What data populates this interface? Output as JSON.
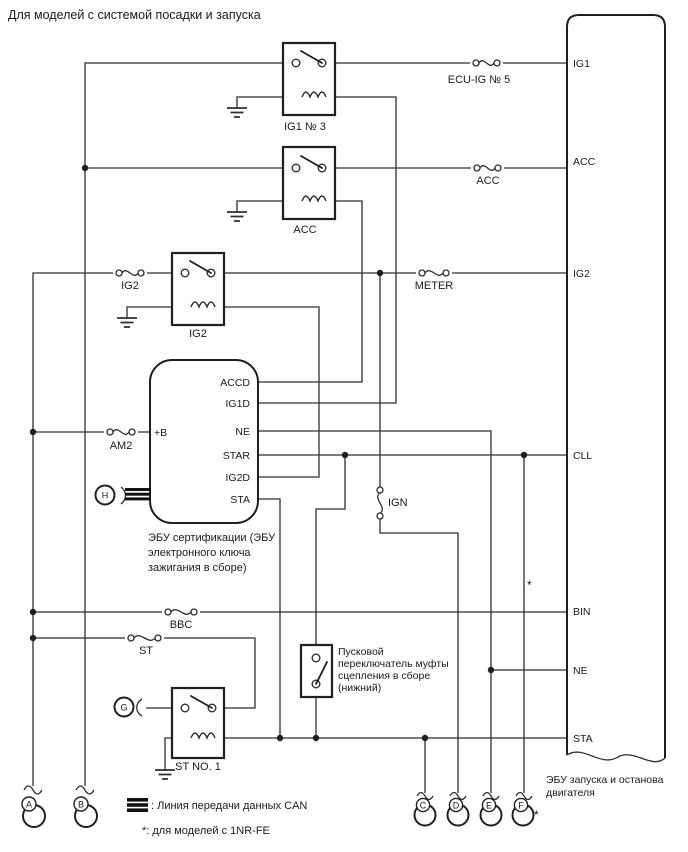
{
  "title": "Для моделей с системой посадки и запуска",
  "relays": {
    "ig1": "IG1 № 3",
    "acc": "ACC",
    "ig2": "IG2",
    "st": "ST NO. 1"
  },
  "fuses": {
    "ecu_ig": "ECU-IG № 5",
    "acc": "ACC",
    "ig2": "IG2",
    "meter": "METER",
    "am2": "AM2",
    "bbc": "BBC",
    "st": "ST",
    "ign": "IGN"
  },
  "certification_ecu": {
    "pins": {
      "accd": "ACCD",
      "ig1d": "IG1D",
      "ne": "NE",
      "star": "STAR",
      "ig2d": "IG2D",
      "sta": "STA",
      "plus_b": "+B"
    },
    "caption_lines": [
      "ЭБУ сертификации (ЭБУ",
      "электронного ключа",
      "зажигания в сборе)"
    ]
  },
  "engine_ecu": {
    "pins": {
      "ig1": "IG1",
      "acc": "ACC",
      "ig2": "IG2",
      "cll": "CLL",
      "bin": "BIN",
      "ne": "NE",
      "sta": "STA"
    },
    "caption_lines": [
      "ЭБУ запуска и останова",
      "двигателя"
    ]
  },
  "clutch_switch": {
    "caption_lines": [
      "Пусковой",
      "переключатель муфты",
      "сцепления в сборе",
      "(нижний)"
    ]
  },
  "connectors": {
    "a": "A",
    "b": "B",
    "c": "C",
    "d": "D",
    "e": "E",
    "f": "F",
    "g": "G",
    "h": "H"
  },
  "asterisk": "*",
  "legend": {
    "can_label": ": Линия передачи данных CAN",
    "note": "*: для моделей с 1NR-FE"
  },
  "colors": {
    "line": "#2e2e2e",
    "text": "#1a1a1a",
    "background": "#ffffff"
  }
}
